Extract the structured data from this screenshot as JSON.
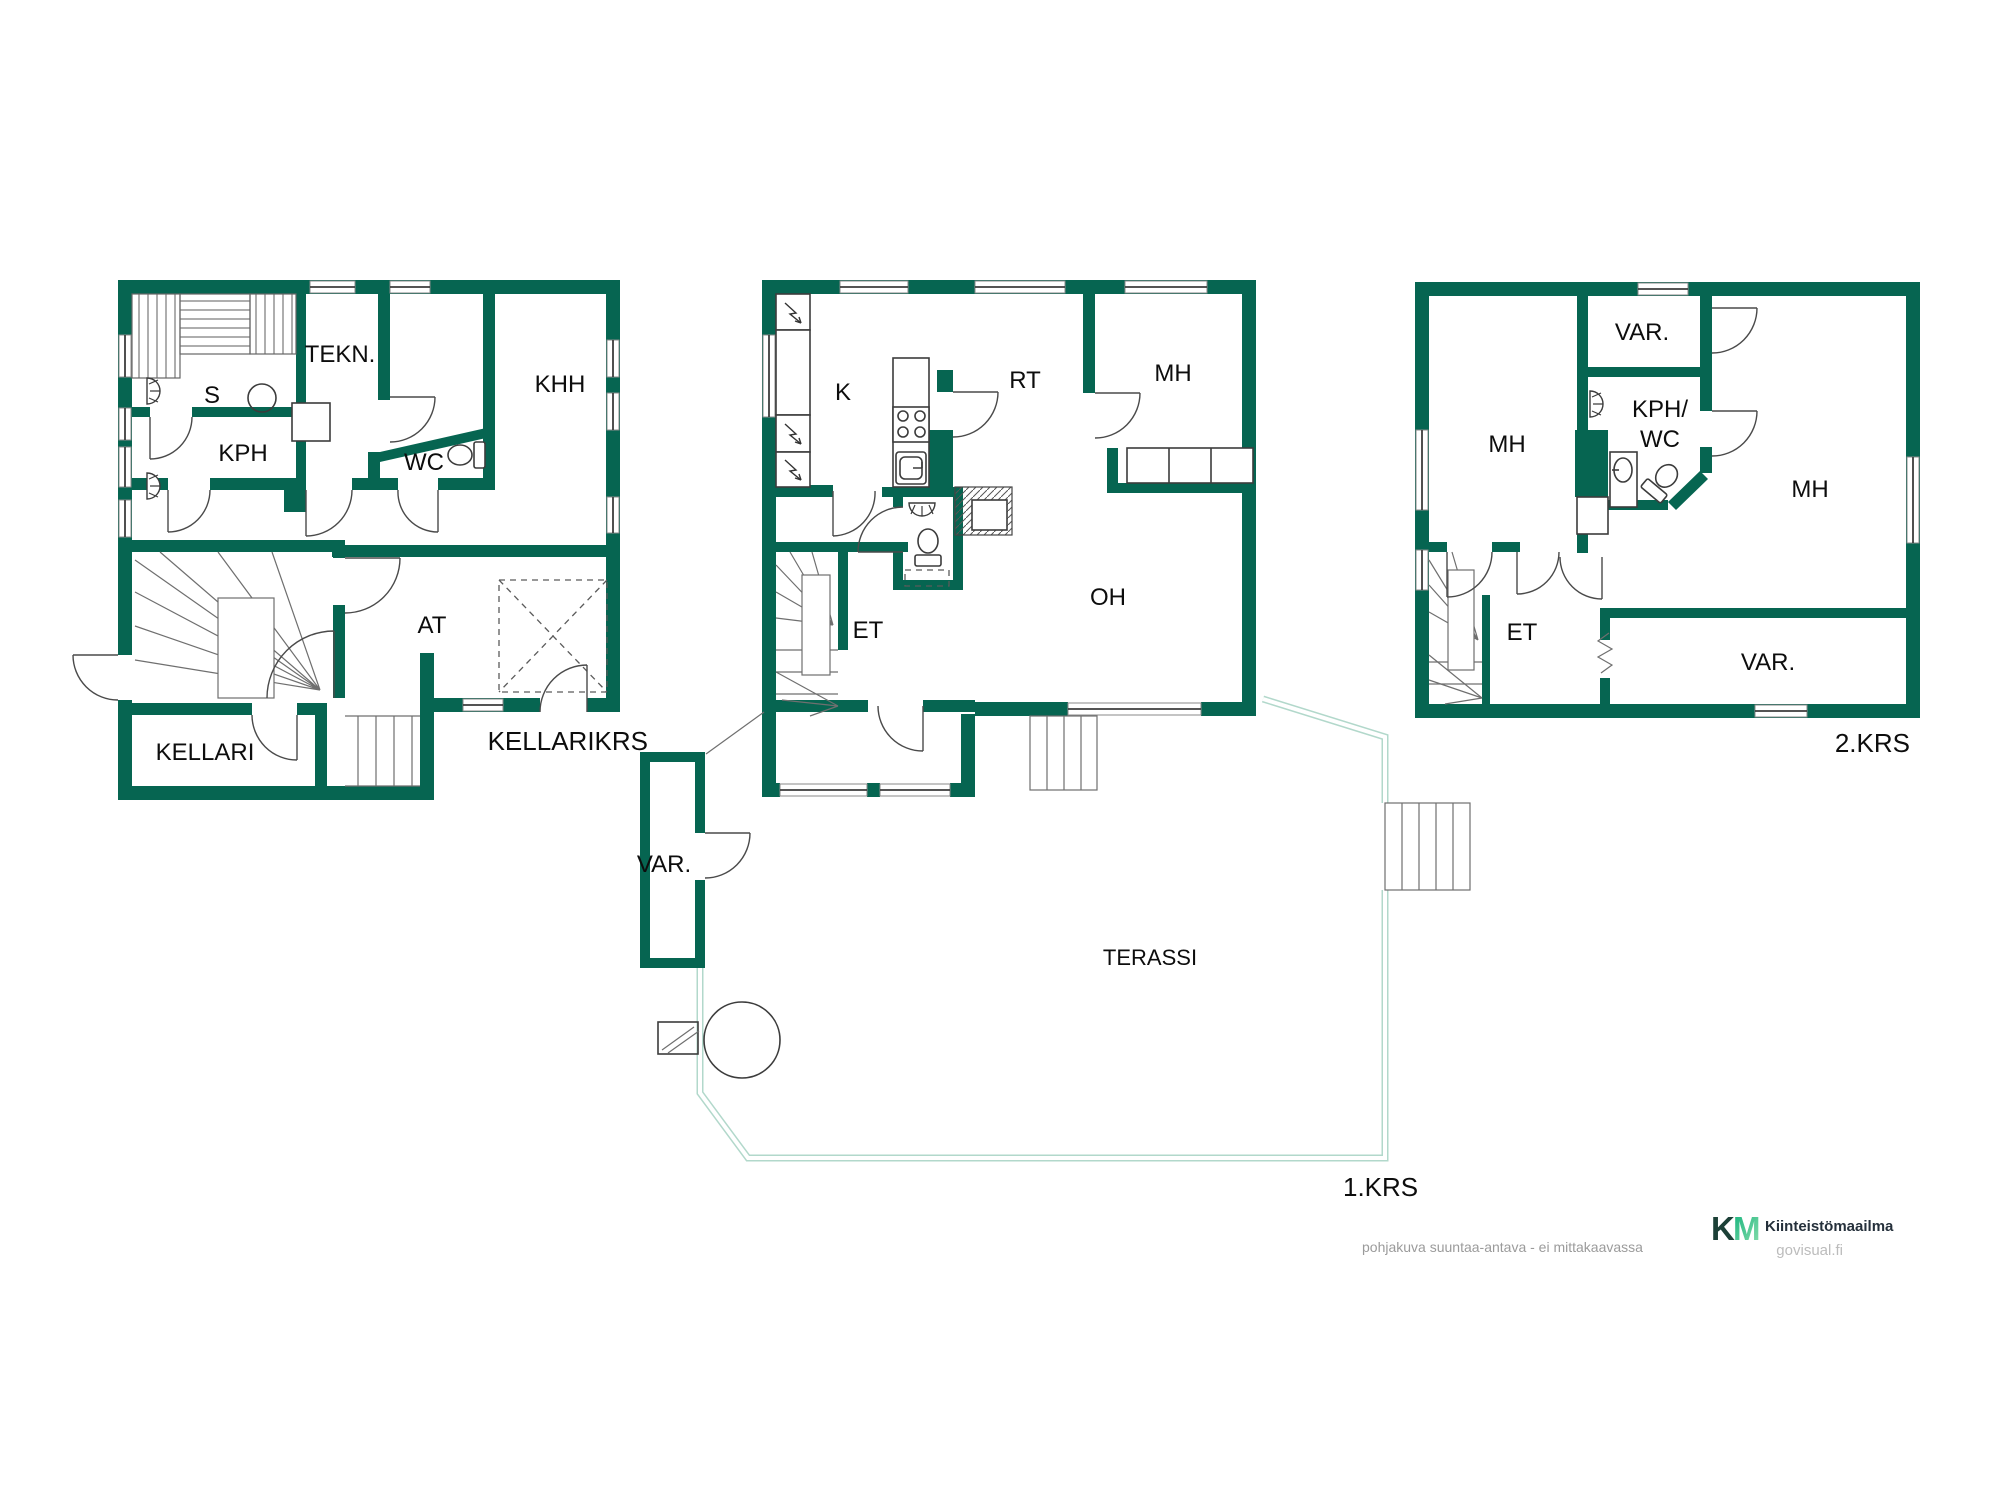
{
  "colors": {
    "wall_green": "#066551",
    "terrace_line": "#b2d8cb",
    "label_black": "#0d0d0d",
    "muted_gray": "#9b9b9b",
    "brand_k": "#1c4037",
    "brand_m_gradient_start": "#12b27b",
    "brand_m_gradient_end": "#8fdfae",
    "brand_text": "#25303b",
    "site_gray": "#bcbcbc"
  },
  "basement": {
    "floor_label": "KELLARIKRS",
    "rooms": {
      "s": "S",
      "kph": "KPH",
      "tekn": "TEKN.",
      "wc": "WC",
      "khh": "KHH",
      "at": "AT",
      "kellari": "KELLARI"
    }
  },
  "floor1": {
    "floor_label": "1.KRS",
    "rooms": {
      "k": "K",
      "rt": "RT",
      "mh": "MH",
      "oh": "OH",
      "et": "ET",
      "var": "VAR.",
      "terassi": "TERASSI"
    }
  },
  "floor2": {
    "floor_label": "2.KRS",
    "rooms": {
      "mh_left": "MH",
      "var_top": "VAR.",
      "kph_wc_line1": "KPH/",
      "kph_wc_line2": "WC",
      "mh_right": "MH",
      "et": "ET",
      "var_bottom": "VAR."
    }
  },
  "footer": {
    "disclaimer": "pohjakuva suuntaa-antava - ei mittakaavassa",
    "brand_k": "K",
    "brand_m": "M",
    "brand_name": "Kiinteistömaailma",
    "website": "govisual.fi"
  }
}
